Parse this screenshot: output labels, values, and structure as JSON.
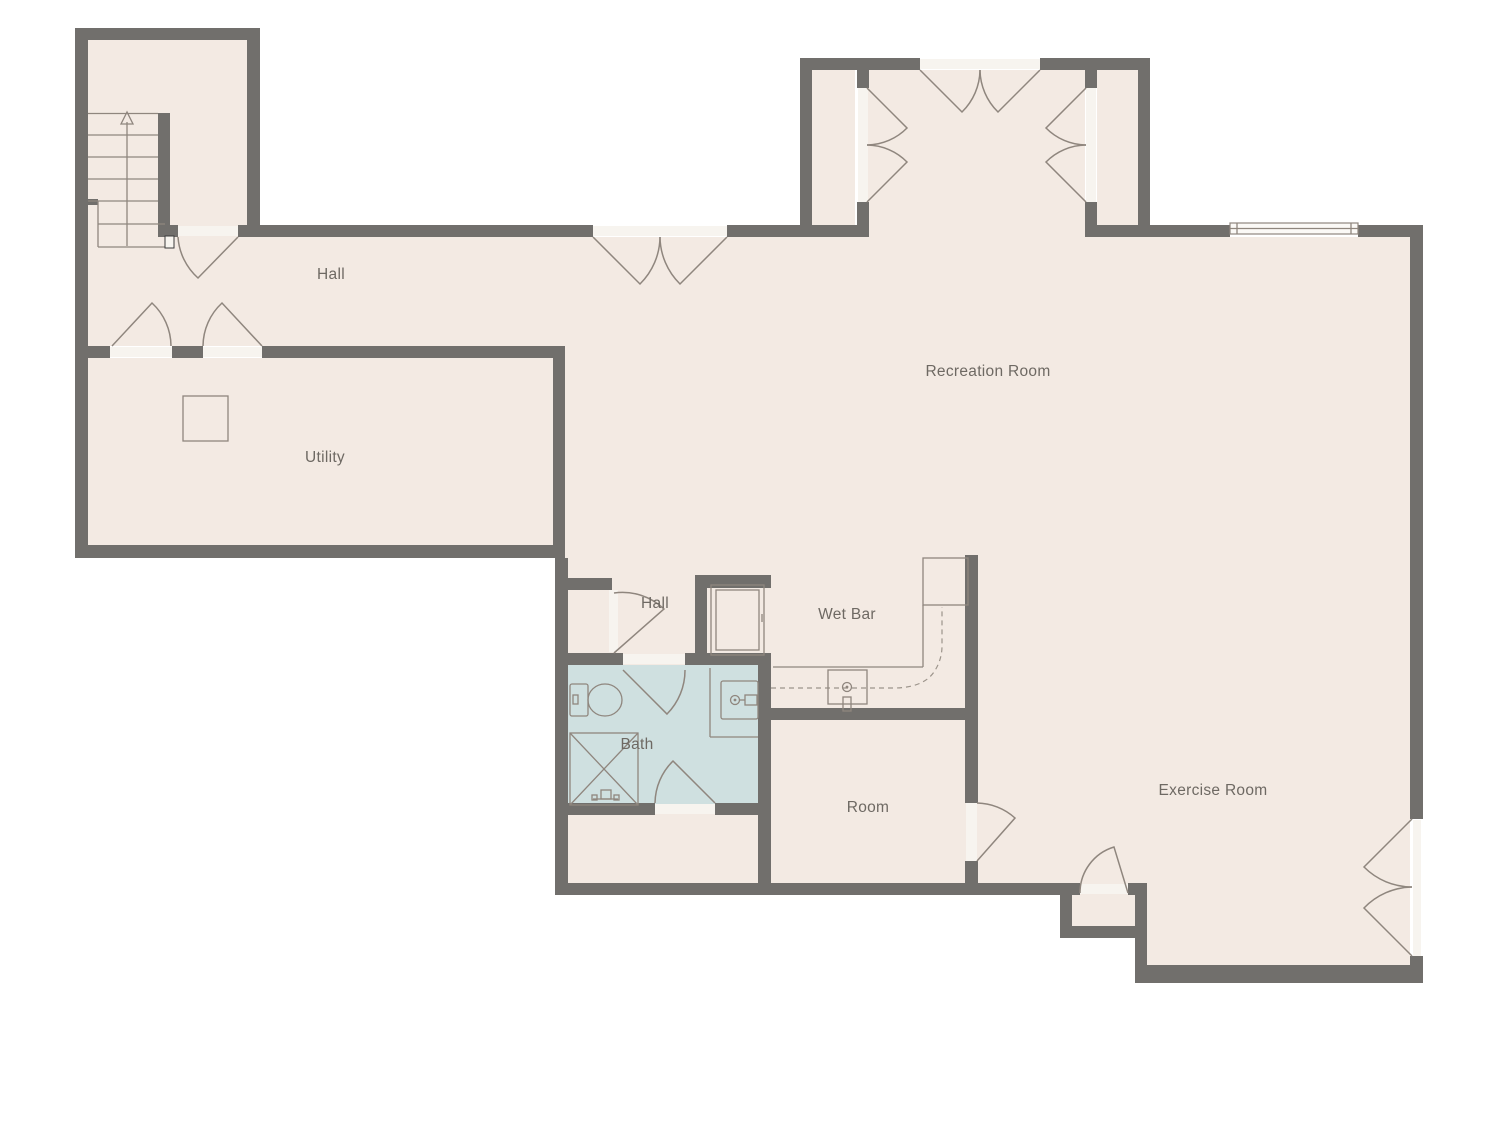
{
  "palette": {
    "background": "#ffffff",
    "wall": "#716f6c",
    "floor": "#f3eae3",
    "bath_floor": "#cfe0e0",
    "door_leaf": "#f7f4ef",
    "line": "#8f867e",
    "text": "#6e6963"
  },
  "rooms": {
    "hall_main": {
      "label": "Hall"
    },
    "utility": {
      "label": "Utility"
    },
    "recreation": {
      "label": "Recreation Room"
    },
    "hall_small": {
      "label": "Hall"
    },
    "wet_bar": {
      "label": "Wet Bar"
    },
    "bath": {
      "label": "Bath"
    },
    "room": {
      "label": "Room"
    },
    "exercise": {
      "label": "Exercise Room"
    }
  },
  "fixtures": [
    "stairs",
    "stairs-direction-arrow",
    "water-heater",
    "window",
    "refrigerator-cabinet",
    "wet-bar-counter",
    "wet-bar-sink",
    "bathroom-sink",
    "toilet",
    "shower",
    "door-swing"
  ]
}
